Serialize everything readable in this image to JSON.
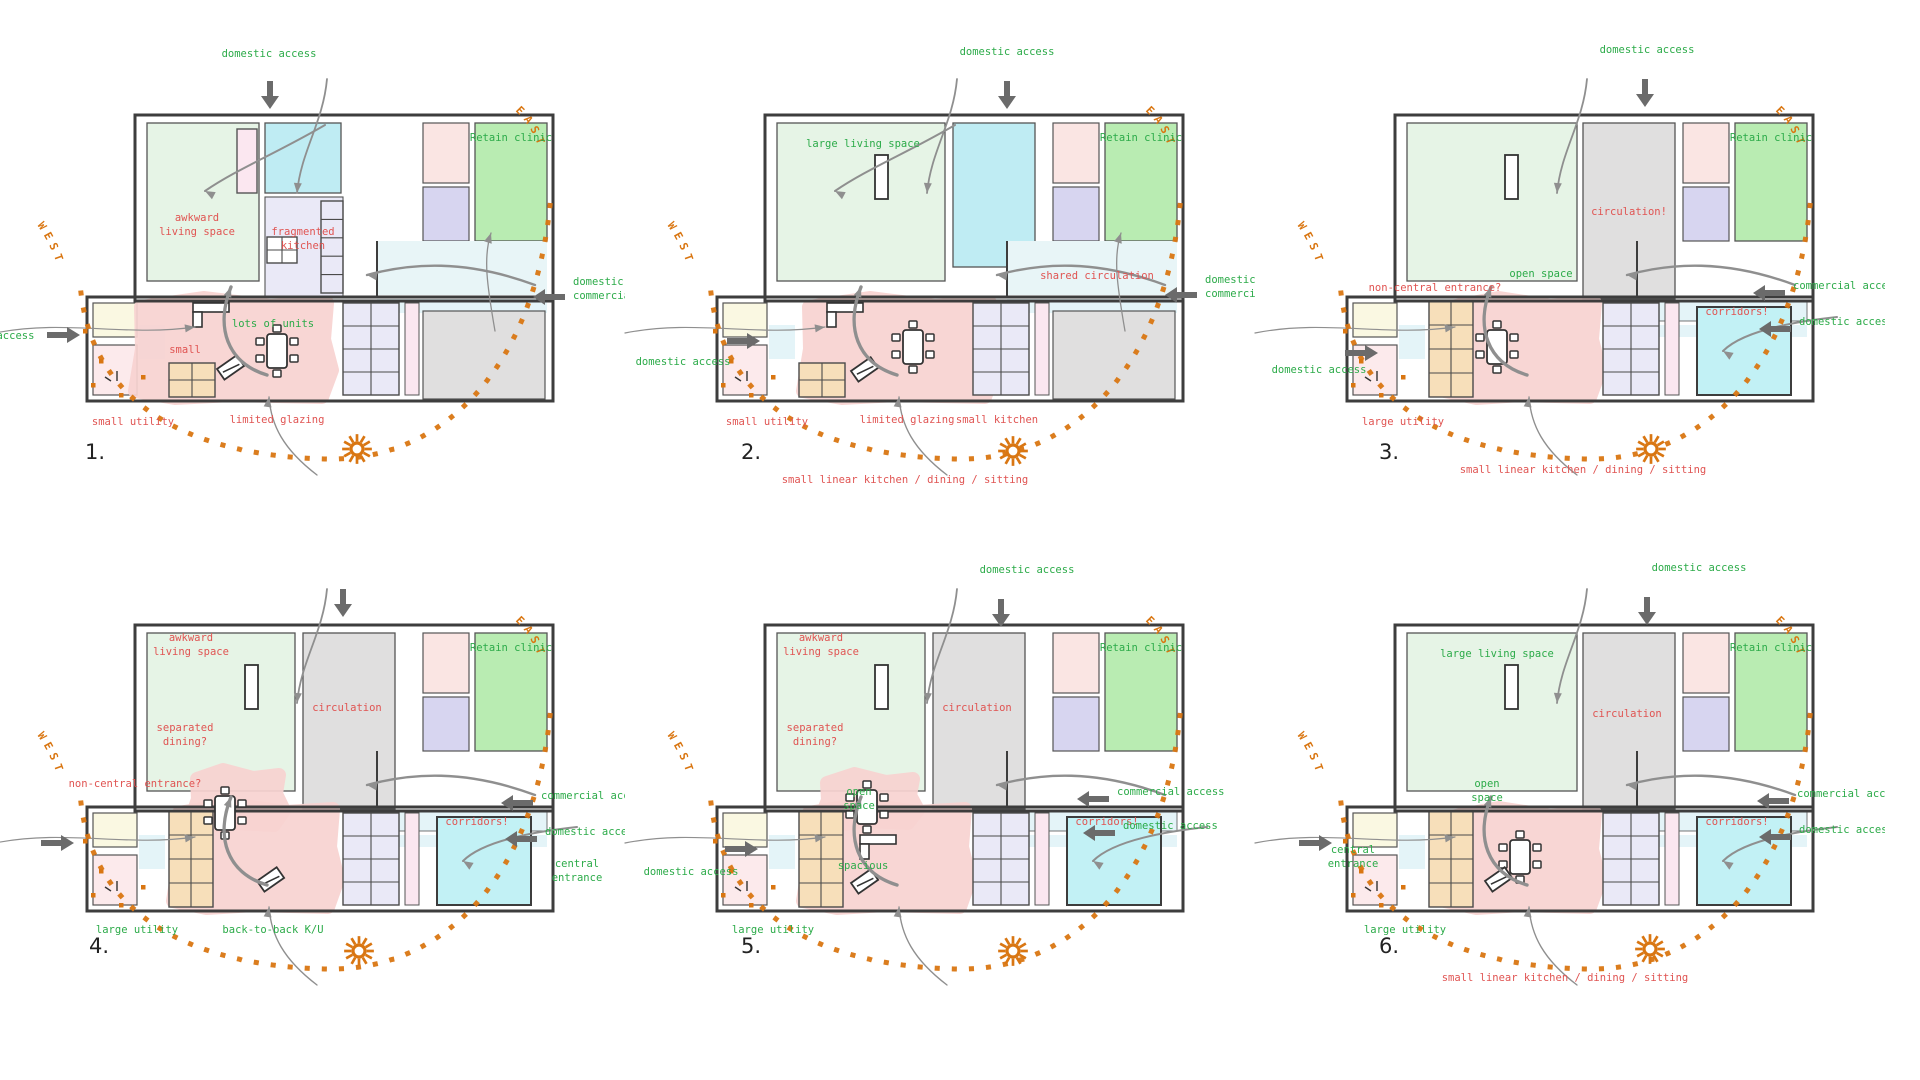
{
  "title": "Floor plan option study - 6 annotated sketch plans",
  "colors": {
    "green": "#2cab49",
    "red": "#e05452",
    "orange": "#d97612",
    "ink": "#3d3d3d",
    "wall": "#555555",
    "flow": "#8f8f8f",
    "access_arrow": "#6b6b6b",
    "number": "#222222",
    "fills": {
      "living": "#e6f4e6",
      "cyan": "#bfecf3",
      "clinic": "#b9ecb2",
      "pinkRoom": "#fae5e3",
      "lavender": "#d7d5f0",
      "gray": "#e0dfdf",
      "corridor": "#e4f4f8",
      "blob": "#f8d3d1",
      "units": "#eae9f7",
      "pinkStrip": "#fbe7f0",
      "orange": "#f7dfba",
      "cream": "#faf8e2",
      "pinkUtil": "#fceaec",
      "cyanRoom": "#c2f1f5",
      "shared": "#e8f5f7"
    }
  },
  "compass": {
    "west": "WEST",
    "east": "EAST"
  },
  "plans": [
    {
      "number": "1.",
      "origin": {
        "x": 25,
        "y": 35
      },
      "variant": {
        "mid": "cyan-small",
        "bottomRight": "gray",
        "utility": "small",
        "livingW": 112,
        "window": "cabinet",
        "sharedZone": true,
        "corridorStrip": false,
        "blob": [
          112,
          266,
          190,
          96
        ],
        "table": [
          252,
          316
        ],
        "desk": [
          168,
          268
        ],
        "tilted": [
          192,
          334
        ]
      },
      "labels": [
        {
          "t": "domestic access",
          "c": "green",
          "x": 244,
          "y": 22,
          "a": "c"
        },
        {
          "t": "awkward\nliving space",
          "c": "red",
          "x": 172,
          "y": 186,
          "a": "c"
        },
        {
          "t": "fragmented\nkitchen",
          "c": "red",
          "x": 278,
          "y": 200,
          "a": "c"
        },
        {
          "t": "Retain clinic",
          "c": "green",
          "x": 486,
          "y": 106,
          "a": "c"
        },
        {
          "t": "lots of units",
          "c": "green",
          "x": 248,
          "y": 292,
          "a": "c"
        },
        {
          "t": "small",
          "c": "red",
          "x": 160,
          "y": 318,
          "a": "c"
        },
        {
          "t": "small utility",
          "c": "red",
          "x": 108,
          "y": 390,
          "a": "c"
        },
        {
          "t": "limited glazing",
          "c": "red",
          "x": 252,
          "y": 388,
          "a": "c"
        },
        {
          "t": "domestic access",
          "c": "green",
          "x": -38,
          "y": 304,
          "a": "c"
        },
        {
          "t": "domestic /\ncommercial access",
          "c": "green",
          "x": 548,
          "y": 250,
          "a": "l"
        }
      ],
      "arrows": [
        {
          "d": "down",
          "x": 245,
          "y": 46
        },
        {
          "d": "right",
          "x": 22,
          "y": 300
        },
        {
          "d": "left",
          "x": 540,
          "y": 262
        }
      ],
      "sun": {
        "x": 332,
        "y": 414
      },
      "num_pos": {
        "x": 60,
        "y": 424
      }
    },
    {
      "number": "2.",
      "origin": {
        "x": 655,
        "y": 35
      },
      "variant": {
        "mid": "cyan-tall",
        "bottomRight": "gray",
        "utility": "small",
        "livingW": 168,
        "window": true,
        "sharedZone": true,
        "corridorStrip": false,
        "blob": [
          150,
          266,
          185,
          96
        ],
        "table": [
          258,
          312
        ],
        "desk": [
          172,
          268
        ],
        "tilted": [
          196,
          336
        ]
      },
      "labels": [
        {
          "t": "domestic access",
          "c": "green",
          "x": 352,
          "y": 20,
          "a": "c"
        },
        {
          "t": "large living space",
          "c": "green",
          "x": 208,
          "y": 112,
          "a": "c"
        },
        {
          "t": "Retain clinic",
          "c": "green",
          "x": 486,
          "y": 106,
          "a": "c"
        },
        {
          "t": "shared circulation",
          "c": "red",
          "x": 442,
          "y": 244,
          "a": "c"
        },
        {
          "t": "small utility",
          "c": "red",
          "x": 112,
          "y": 390,
          "a": "c"
        },
        {
          "t": "limited glazing",
          "c": "red",
          "x": 252,
          "y": 388,
          "a": "c"
        },
        {
          "t": "small kitchen",
          "c": "red",
          "x": 342,
          "y": 388,
          "a": "c"
        },
        {
          "t": "small linear kitchen / dining / sitting",
          "c": "red",
          "x": 250,
          "y": 448,
          "a": "c"
        },
        {
          "t": "domestic access",
          "c": "green",
          "x": 28,
          "y": 330,
          "a": "c"
        },
        {
          "t": "domestic /\ncommercial access",
          "c": "green",
          "x": 550,
          "y": 248,
          "a": "l"
        }
      ],
      "arrows": [
        {
          "d": "down",
          "x": 352,
          "y": 46
        },
        {
          "d": "right",
          "x": 72,
          "y": 306
        },
        {
          "d": "left",
          "x": 542,
          "y": 260
        }
      ],
      "sun": {
        "x": 358,
        "y": 416
      },
      "num_pos": {
        "x": 86,
        "y": 424
      }
    },
    {
      "number": "3.",
      "origin": {
        "x": 1285,
        "y": 35
      },
      "variant": {
        "mid": "gray",
        "midX": 298,
        "bottomRight": "cyan",
        "utility": "large",
        "livingW": 170,
        "window": true,
        "sharedZone": false,
        "corridorStrip": true,
        "blob": [
          162,
          266,
          148,
          96
        ],
        "table": [
          212,
          312
        ]
      },
      "labels": [
        {
          "t": "domestic access",
          "c": "green",
          "x": 362,
          "y": 18,
          "a": "c"
        },
        {
          "t": "non-central entrance?",
          "c": "red",
          "x": 150,
          "y": 256,
          "a": "c"
        },
        {
          "t": "open space",
          "c": "green",
          "x": 256,
          "y": 242,
          "a": "c"
        },
        {
          "t": "circulation!",
          "c": "red",
          "x": 344,
          "y": 180,
          "a": "c"
        },
        {
          "t": "Retain clinic",
          "c": "green",
          "x": 486,
          "y": 106,
          "a": "c"
        },
        {
          "t": "corridors!",
          "c": "red",
          "x": 452,
          "y": 280,
          "a": "c"
        },
        {
          "t": "commercial access",
          "c": "green",
          "x": 508,
          "y": 254,
          "a": "l"
        },
        {
          "t": "domestic access",
          "c": "green",
          "x": 514,
          "y": 290,
          "a": "l"
        },
        {
          "t": "domestic access",
          "c": "green",
          "x": 34,
          "y": 338,
          "a": "c"
        },
        {
          "t": "large utility",
          "c": "red",
          "x": 118,
          "y": 390,
          "a": "c"
        },
        {
          "t": "small linear kitchen / dining / sitting",
          "c": "red",
          "x": 298,
          "y": 438,
          "a": "c"
        }
      ],
      "arrows": [
        {
          "d": "down",
          "x": 360,
          "y": 44
        },
        {
          "d": "right",
          "x": 60,
          "y": 318
        },
        {
          "d": "left",
          "x": 500,
          "y": 258
        },
        {
          "d": "left",
          "x": 506,
          "y": 294
        }
      ],
      "sun": {
        "x": 366,
        "y": 414
      },
      "num_pos": {
        "x": 94,
        "y": 424
      }
    },
    {
      "number": "4.",
      "origin": {
        "x": 25,
        "y": 545
      },
      "variant": {
        "mid": "gray",
        "midX": 278,
        "bottomRight": "cyan",
        "utility": "large",
        "livingW": 148,
        "window": true,
        "sharedZone": false,
        "corridorStrip": true,
        "blob": [
          150,
          262,
          158,
          100
        ],
        "blob2": [
          168,
          228,
          86,
          52
        ],
        "table": [
          200,
          268
        ],
        "tilted": [
          232,
          336
        ]
      },
      "labels": [
        {
          "t": "awkward\nliving space",
          "c": "red",
          "x": 166,
          "y": 96,
          "a": "c"
        },
        {
          "t": "separated\ndining?",
          "c": "red",
          "x": 160,
          "y": 186,
          "a": "c"
        },
        {
          "t": "circulation",
          "c": "red",
          "x": 322,
          "y": 166,
          "a": "c"
        },
        {
          "t": "Retain clinic",
          "c": "green",
          "x": 486,
          "y": 106,
          "a": "c"
        },
        {
          "t": "corridors!",
          "c": "red",
          "x": 452,
          "y": 280,
          "a": "c"
        },
        {
          "t": "non-central entrance?",
          "c": "red",
          "x": 110,
          "y": 242,
          "a": "c"
        },
        {
          "t": "commercial access",
          "c": "green",
          "x": 516,
          "y": 254,
          "a": "l"
        },
        {
          "t": "domestic access",
          "c": "green",
          "x": 520,
          "y": 290,
          "a": "l"
        },
        {
          "t": "central\nentrance",
          "c": "green",
          "x": 552,
          "y": 322,
          "a": "c"
        },
        {
          "t": "large utility",
          "c": "green",
          "x": 112,
          "y": 388,
          "a": "c"
        },
        {
          "t": "back-to-back K/U",
          "c": "green",
          "x": 248,
          "y": 388,
          "a": "c"
        }
      ],
      "arrows": [
        {
          "d": "down",
          "x": 318,
          "y": 44
        },
        {
          "d": "right",
          "x": 16,
          "y": 298
        },
        {
          "d": "left",
          "x": 508,
          "y": 258
        },
        {
          "d": "left",
          "x": 512,
          "y": 294
        }
      ],
      "sun": {
        "x": 334,
        "y": 406
      },
      "num_pos": {
        "x": 64,
        "y": 408
      }
    },
    {
      "number": "5.",
      "origin": {
        "x": 655,
        "y": 545
      },
      "variant": {
        "mid": "gray",
        "midX": 278,
        "bottomRight": "cyan",
        "utility": "large",
        "livingW": 148,
        "window": true,
        "sharedZone": false,
        "corridorStrip": true,
        "blob": [
          150,
          262,
          160,
          100
        ],
        "blob2": [
          168,
          232,
          90,
          46
        ],
        "table": [
          212,
          262
        ],
        "desk": [
          205,
          290
        ],
        "tilted": [
          196,
          338
        ]
      },
      "labels": [
        {
          "t": "domestic access",
          "c": "green",
          "x": 372,
          "y": 28,
          "a": "c"
        },
        {
          "t": "awkward\nliving space",
          "c": "red",
          "x": 166,
          "y": 96,
          "a": "c"
        },
        {
          "t": "separated\ndining?",
          "c": "red",
          "x": 160,
          "y": 186,
          "a": "c"
        },
        {
          "t": "circulation",
          "c": "red",
          "x": 322,
          "y": 166,
          "a": "c"
        },
        {
          "t": "Retain clinic",
          "c": "green",
          "x": 486,
          "y": 106,
          "a": "c"
        },
        {
          "t": "corridors!",
          "c": "red",
          "x": 452,
          "y": 280,
          "a": "c"
        },
        {
          "t": "open\nspace",
          "c": "green",
          "x": 204,
          "y": 250,
          "a": "c"
        },
        {
          "t": "spacious",
          "c": "green",
          "x": 208,
          "y": 324,
          "a": "c"
        },
        {
          "t": "commercial access",
          "c": "green",
          "x": 462,
          "y": 250,
          "a": "l"
        },
        {
          "t": "domestic access",
          "c": "green",
          "x": 468,
          "y": 284,
          "a": "l"
        },
        {
          "t": "domestic access",
          "c": "green",
          "x": 36,
          "y": 330,
          "a": "c"
        },
        {
          "t": "large utility",
          "c": "green",
          "x": 118,
          "y": 388,
          "a": "c"
        }
      ],
      "arrows": [
        {
          "d": "down",
          "x": 346,
          "y": 54
        },
        {
          "d": "right",
          "x": 70,
          "y": 304
        },
        {
          "d": "left",
          "x": 454,
          "y": 254
        },
        {
          "d": "left",
          "x": 460,
          "y": 288
        }
      ],
      "sun": {
        "x": 358,
        "y": 406
      },
      "num_pos": {
        "x": 86,
        "y": 408
      }
    },
    {
      "number": "6.",
      "origin": {
        "x": 1285,
        "y": 545
      },
      "variant": {
        "mid": "gray",
        "midX": 298,
        "bottomRight": "cyan",
        "utility": "large",
        "livingW": 170,
        "window": true,
        "sharedZone": false,
        "corridorStrip": true,
        "blob": [
          162,
          266,
          148,
          96
        ],
        "table": [
          235,
          312
        ],
        "tilted": [
          200,
          336
        ]
      },
      "labels": [
        {
          "t": "domestic access",
          "c": "green",
          "x": 414,
          "y": 26,
          "a": "c"
        },
        {
          "t": "large living space",
          "c": "green",
          "x": 212,
          "y": 112,
          "a": "c"
        },
        {
          "t": "circulation",
          "c": "red",
          "x": 342,
          "y": 172,
          "a": "c"
        },
        {
          "t": "Retain clinic",
          "c": "green",
          "x": 486,
          "y": 106,
          "a": "c"
        },
        {
          "t": "corridors!",
          "c": "red",
          "x": 452,
          "y": 280,
          "a": "c"
        },
        {
          "t": "open\nspace",
          "c": "green",
          "x": 202,
          "y": 242,
          "a": "c"
        },
        {
          "t": "central\nentrance",
          "c": "green",
          "x": 68,
          "y": 308,
          "a": "c"
        },
        {
          "t": "large utility",
          "c": "green",
          "x": 120,
          "y": 388,
          "a": "c"
        },
        {
          "t": "small linear kitchen / dining / sitting",
          "c": "red",
          "x": 280,
          "y": 436,
          "a": "c"
        },
        {
          "t": "commercial access",
          "c": "green",
          "x": 512,
          "y": 252,
          "a": "l"
        },
        {
          "t": "domestic access",
          "c": "green",
          "x": 514,
          "y": 288,
          "a": "l"
        }
      ],
      "arrows": [
        {
          "d": "down",
          "x": 362,
          "y": 52
        },
        {
          "d": "right",
          "x": 14,
          "y": 298
        },
        {
          "d": "left",
          "x": 504,
          "y": 256
        },
        {
          "d": "left",
          "x": 506,
          "y": 292
        }
      ],
      "sun": {
        "x": 365,
        "y": 404
      },
      "num_pos": {
        "x": 94,
        "y": 408
      }
    }
  ]
}
